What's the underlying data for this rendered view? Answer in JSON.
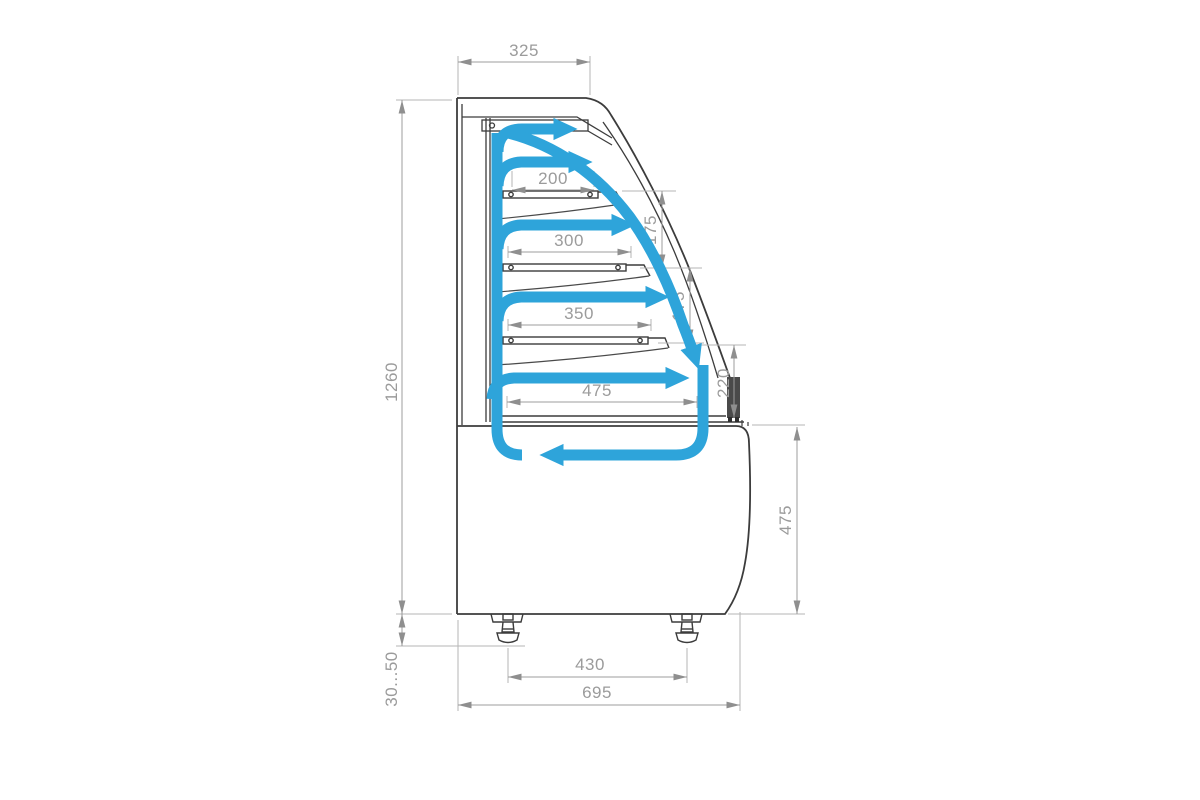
{
  "diagram": {
    "type": "technical-drawing",
    "subject": "refrigerated display case side section with airflow",
    "colors": {
      "airflow_blue": "#2EA4DA",
      "outline_dark": "#3c3c3c",
      "dimension_gray": "#9b9b9b"
    },
    "dims": {
      "top_depth": "325",
      "shelf1_depth": "200",
      "shelf2_depth": "300",
      "shelf3_depth": "350",
      "deck_depth": "475",
      "shelf_gap_1": "175",
      "shelf_gap_2": "175",
      "front_sill_height": "220",
      "total_height": "1260",
      "base_height": "475",
      "feet_spacing": "430",
      "overall_depth": "695",
      "feet_range": "30...50"
    }
  }
}
